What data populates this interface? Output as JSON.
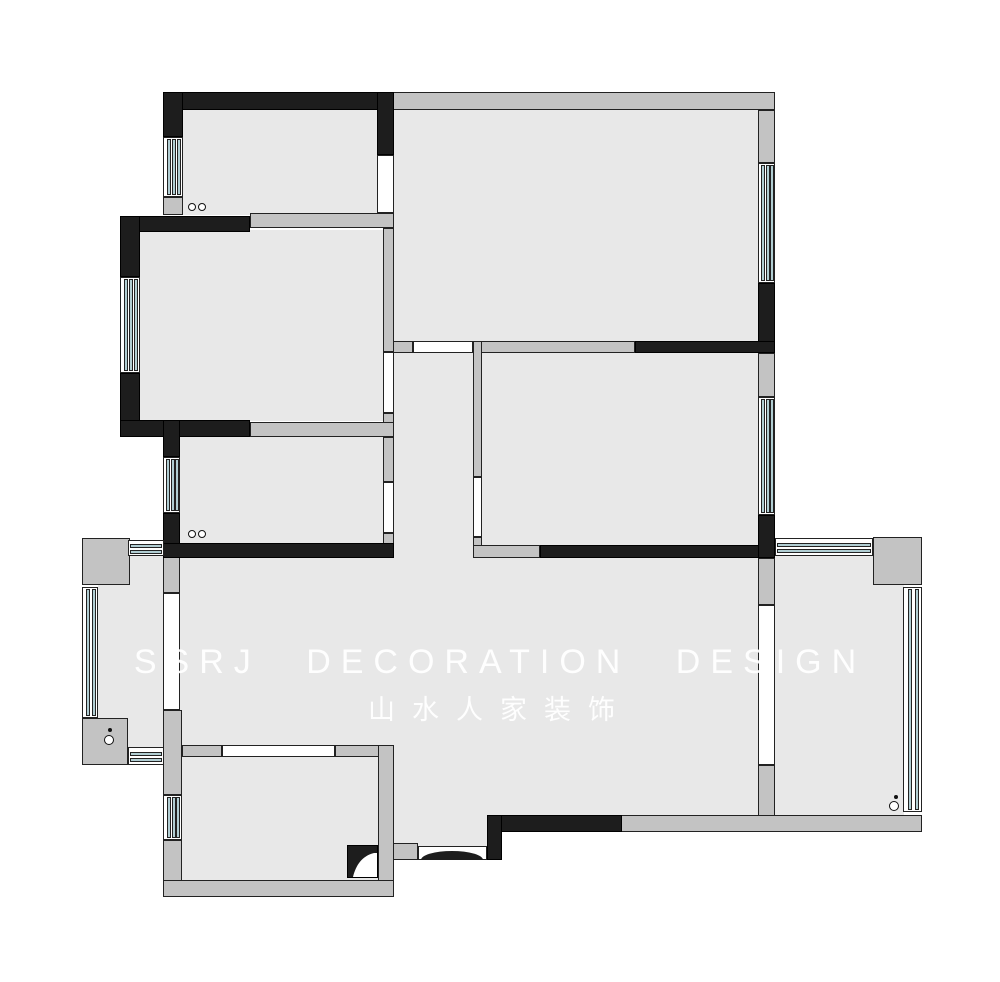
{
  "watermark": {
    "line1": "SSRJ  DECORATION  DESIGN",
    "line2": "山水人家装饰"
  },
  "palette": {
    "floor": "#e8e8e8",
    "wall-gray": "#c3c3c3",
    "wall-black": "#1d1d1d",
    "window-blue": "#b1ced3",
    "outline": "#222222",
    "bg": "#ffffff"
  },
  "floorplan": {
    "floors": [
      {
        "name": "room-top-left-floor",
        "r": [
          180,
          110,
          197,
          105
        ]
      },
      {
        "name": "room-mid-left-floor",
        "r": [
          140,
          230,
          244,
          191
        ]
      },
      {
        "name": "room-small-left-floor",
        "r": [
          180,
          436,
          203,
          108
        ]
      },
      {
        "name": "living-room-floor",
        "r": [
          394,
          110,
          364,
          232
        ]
      },
      {
        "name": "bedroom-right-floor",
        "r": [
          481,
          353,
          277,
          193
        ]
      },
      {
        "name": "corridor-floor",
        "r": [
          394,
          352,
          79,
          206
        ]
      },
      {
        "name": "central-hall-floor",
        "r": [
          394,
          557,
          364,
          259
        ]
      },
      {
        "name": "dining-floor",
        "r": [
          180,
          557,
          214,
          189
        ]
      },
      {
        "name": "vestibule-floor",
        "r": [
          394,
          745,
          93,
          106
        ]
      },
      {
        "name": "kitchen-floor",
        "r": [
          181,
          756,
          198,
          125
        ]
      },
      {
        "name": "balcony-left-floor",
        "r": [
          98,
          556,
          66,
          192
        ]
      },
      {
        "name": "balcony-right-floor",
        "r": [
          775,
          556,
          129,
          260
        ]
      }
    ],
    "gray_walls": [
      {
        "name": "living-top-wall",
        "r": [
          393,
          92,
          382,
          18
        ]
      },
      {
        "name": "living-right-wall-upper",
        "r": [
          758,
          110,
          17,
          53
        ]
      },
      {
        "name": "room-top-left-bottom-wall",
        "r": [
          250,
          213,
          144,
          15
        ]
      },
      {
        "name": "room-top-left-stub-wall",
        "r": [
          163,
          197,
          20,
          18
        ]
      },
      {
        "name": "room-mid-left-right-wall-upper",
        "r": [
          383,
          228,
          11,
          124
        ]
      },
      {
        "name": "room-mid-left-right-wall-lower",
        "r": [
          383,
          413,
          11,
          24
        ]
      },
      {
        "name": "room-small-left-top-wall",
        "r": [
          250,
          422,
          144,
          15
        ]
      },
      {
        "name": "room-small-left-right-wall-upper",
        "r": [
          383,
          437,
          11,
          45
        ]
      },
      {
        "name": "room-small-left-right-wall-lower",
        "r": [
          383,
          533,
          11,
          11
        ]
      },
      {
        "name": "living-bottom-wall-left",
        "r": [
          393,
          341,
          20,
          12
        ]
      },
      {
        "name": "living-bottom-wall-mid",
        "r": [
          473,
          341,
          162,
          12
        ]
      },
      {
        "name": "bedroom-right-left-wall-upper",
        "r": [
          473,
          341,
          9,
          136
        ]
      },
      {
        "name": "bedroom-right-left-wall-lower",
        "r": [
          473,
          537,
          9,
          10
        ]
      },
      {
        "name": "bedroom-right-bottom-wall-left",
        "r": [
          473,
          545,
          67,
          13
        ]
      },
      {
        "name": "bedroom-right-right-wall-upper",
        "r": [
          758,
          353,
          17,
          44
        ]
      },
      {
        "name": "balcony-right-sep-wall-upper",
        "r": [
          758,
          558,
          17,
          47
        ]
      },
      {
        "name": "balcony-right-sep-wall-lower",
        "r": [
          758,
          765,
          17,
          66
        ]
      },
      {
        "name": "south-perimeter-wall",
        "r": [
          620,
          815,
          302,
          17
        ]
      },
      {
        "name": "balcony-right-corner-ne",
        "r": [
          873,
          537,
          49,
          48
        ]
      },
      {
        "name": "balcony-left-corner-nw",
        "r": [
          82,
          538,
          48,
          47
        ]
      },
      {
        "name": "balcony-left-corner-sw",
        "r": [
          82,
          718,
          46,
          47
        ]
      },
      {
        "name": "balcony-left-sep-wall-upper",
        "r": [
          163,
          553,
          17,
          40
        ]
      },
      {
        "name": "kitchen-left-wall-upper",
        "r": [
          163,
          710,
          19,
          85
        ]
      },
      {
        "name": "kitchen-left-wall-lower",
        "r": [
          163,
          840,
          19,
          57
        ]
      },
      {
        "name": "kitchen-top-wall-left",
        "r": [
          182,
          745,
          40,
          12
        ]
      },
      {
        "name": "kitchen-top-wall-right",
        "r": [
          335,
          745,
          59,
          12
        ]
      },
      {
        "name": "kitchen-right-wall",
        "r": [
          378,
          745,
          16,
          152
        ]
      },
      {
        "name": "kitchen-bottom-wall",
        "r": [
          163,
          880,
          231,
          17
        ]
      },
      {
        "name": "entry-side-stub-wall",
        "r": [
          393,
          843,
          25,
          17
        ]
      }
    ],
    "black_walls": [
      {
        "name": "room-top-left-top-wall",
        "r": [
          163,
          92,
          231,
          18
        ]
      },
      {
        "name": "room-top-left-left-wall",
        "r": [
          163,
          92,
          20,
          45
        ]
      },
      {
        "name": "room-top-left-right-wall",
        "r": [
          377,
          92,
          17,
          63
        ]
      },
      {
        "name": "room-mid-left-top-wall",
        "r": [
          120,
          216,
          130,
          16
        ]
      },
      {
        "name": "room-mid-left-left-wall-upper",
        "r": [
          120,
          216,
          20,
          61
        ]
      },
      {
        "name": "room-mid-left-left-wall-lower",
        "r": [
          120,
          373,
          20,
          64
        ]
      },
      {
        "name": "room-mid-left-bottom-wall",
        "r": [
          120,
          420,
          130,
          17
        ]
      },
      {
        "name": "room-small-left-left-wall-upper",
        "r": [
          163,
          420,
          17,
          37
        ]
      },
      {
        "name": "room-small-left-left-wall-lower",
        "r": [
          163,
          513,
          17,
          45
        ]
      },
      {
        "name": "room-small-left-bottom-wall",
        "r": [
          163,
          543,
          231,
          15
        ]
      },
      {
        "name": "living-right-wall-lower",
        "r": [
          758,
          283,
          17,
          70
        ]
      },
      {
        "name": "living-bottom-wall-right",
        "r": [
          635,
          341,
          140,
          12
        ]
      },
      {
        "name": "bedroom-right-bottom-wall",
        "r": [
          540,
          545,
          235,
          13
        ]
      },
      {
        "name": "bedroom-right-se-corner",
        "r": [
          758,
          515,
          17,
          43
        ]
      },
      {
        "name": "entry-wall-horizontal",
        "r": [
          487,
          815,
          135,
          17
        ]
      },
      {
        "name": "entry-wall-vertical",
        "r": [
          487,
          815,
          15,
          45
        ]
      }
    ],
    "openings": [
      {
        "name": "room-top-left-door-opening",
        "r": [
          377,
          155,
          17,
          58
        ]
      },
      {
        "name": "room-mid-left-door-opening",
        "r": [
          383,
          352,
          11,
          61
        ]
      },
      {
        "name": "room-small-left-door-opening",
        "r": [
          383,
          482,
          11,
          51
        ]
      },
      {
        "name": "living-corridor-opening",
        "r": [
          413,
          341,
          60,
          12
        ]
      },
      {
        "name": "bedroom-right-door-opening",
        "r": [
          473,
          477,
          9,
          60
        ]
      },
      {
        "name": "balcony-left-slider-opening",
        "r": [
          163,
          593,
          17,
          117
        ]
      },
      {
        "name": "balcony-right-slider-opening",
        "r": [
          758,
          605,
          17,
          160
        ]
      },
      {
        "name": "kitchen-pass-opening",
        "r": [
          222,
          745,
          113,
          12
        ]
      },
      {
        "name": "entry-door-opening",
        "r": [
          418,
          846,
          69,
          14
        ]
      }
    ],
    "windows": [
      {
        "name": "room-top-left-window",
        "r": [
          163,
          137,
          20,
          60
        ],
        "orient": "v",
        "panes": 3
      },
      {
        "name": "room-mid-left-window",
        "r": [
          120,
          277,
          20,
          96
        ],
        "orient": "v",
        "panes": 3
      },
      {
        "name": "room-small-left-window",
        "r": [
          163,
          457,
          17,
          56
        ],
        "orient": "v",
        "panes": 3
      },
      {
        "name": "kitchen-window",
        "r": [
          163,
          795,
          19,
          45
        ],
        "orient": "v",
        "panes": 3
      },
      {
        "name": "balcony-left-window-west",
        "r": [
          82,
          587,
          16,
          131
        ],
        "orient": "v",
        "panes": 2
      },
      {
        "name": "living-window",
        "r": [
          758,
          163,
          17,
          120
        ],
        "orient": "v",
        "panes": 3
      },
      {
        "name": "bedroom-right-window",
        "r": [
          758,
          397,
          17,
          118
        ],
        "orient": "v",
        "panes": 3
      },
      {
        "name": "balcony-right-window-east",
        "r": [
          903,
          587,
          19,
          225
        ],
        "orient": "v",
        "panes": 2
      },
      {
        "name": "balcony-left-window-top",
        "r": [
          128,
          540,
          36,
          16
        ],
        "orient": "h",
        "panes": 2
      },
      {
        "name": "balcony-left-window-bottom",
        "r": [
          128,
          747,
          36,
          18
        ],
        "orient": "h",
        "panes": 2
      },
      {
        "name": "balcony-right-window-top",
        "r": [
          775,
          538,
          98,
          18
        ],
        "orient": "h",
        "panes": 2
      }
    ],
    "markers": {
      "circles": [
        {
          "name": "room-top-left-marker-a",
          "cx": 192,
          "cy": 207,
          "rad": 4
        },
        {
          "name": "room-top-left-marker-b",
          "cx": 202,
          "cy": 207,
          "rad": 4
        },
        {
          "name": "room-small-left-marker-a",
          "cx": 192,
          "cy": 534,
          "rad": 4
        },
        {
          "name": "room-small-left-marker-b",
          "cx": 202,
          "cy": 534,
          "rad": 4
        },
        {
          "name": "balcony-left-drain-marker",
          "cx": 109,
          "cy": 740,
          "rad": 5
        },
        {
          "name": "balcony-right-drain-marker",
          "cx": 894,
          "cy": 806,
          "rad": 5
        }
      ],
      "dots": [
        {
          "name": "balcony-left-dot-marker",
          "cx": 110,
          "cy": 730,
          "rad": 2
        },
        {
          "name": "balcony-right-dot-marker",
          "cx": 896,
          "cy": 797,
          "rad": 2
        }
      ]
    },
    "flue": {
      "name": "kitchen-flue-symbol",
      "r": [
        347,
        845,
        31,
        33
      ]
    },
    "entry_arc": {
      "name": "entry-door-arc",
      "r": [
        421,
        851,
        62,
        9
      ]
    }
  }
}
